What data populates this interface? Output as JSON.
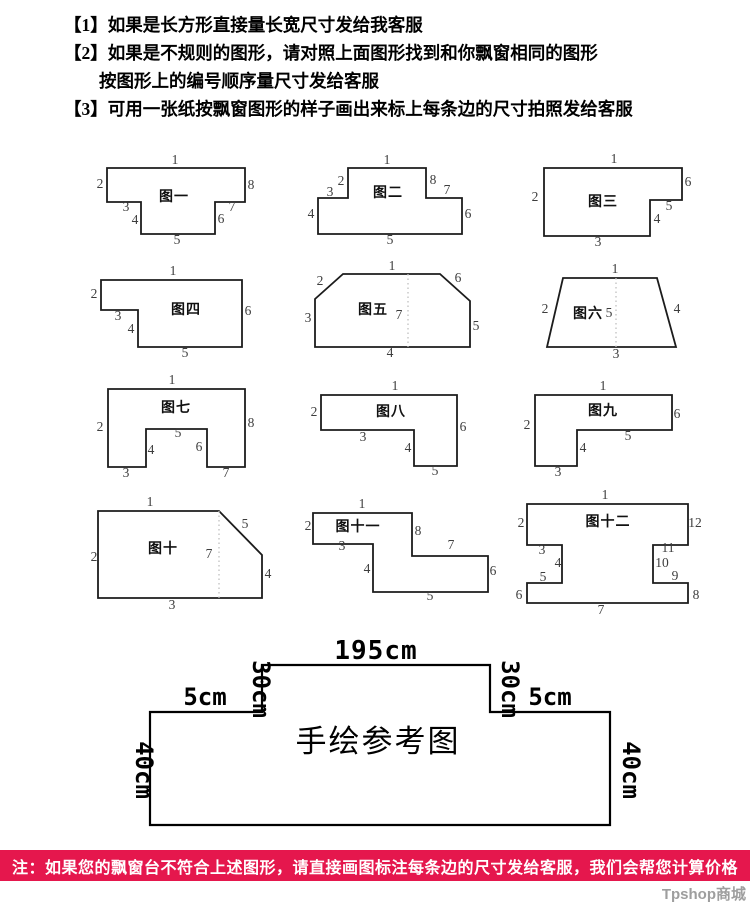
{
  "instructions": [
    "【1】如果是长方形直接量长宽尺寸发给我客服",
    "【2】如果是不规则的图形，请对照上面图形找到和你飘窗相同的图形",
    "按图形上的编号顺序量尺寸发给客服",
    "【3】可用一张纸按飘窗图形的样子画出来标上每条边的尺寸拍照发给客服"
  ],
  "figures": [
    {
      "name": "figure-1",
      "title": "图一",
      "box": [
        95,
        150,
        165,
        95
      ],
      "points": "12,18 150,18 150,52 120,52 120,84 46,84 46,52 12,52",
      "title_pos": [
        79,
        51
      ],
      "labels": [
        [
          "1",
          80,
          14
        ],
        [
          "2",
          5,
          38
        ],
        [
          "3",
          31,
          61
        ],
        [
          "4",
          40,
          74
        ],
        [
          "5",
          82,
          94
        ],
        [
          "6",
          126,
          73
        ],
        [
          "7",
          137,
          61
        ],
        [
          "8",
          156,
          39
        ]
      ]
    },
    {
      "name": "figure-2",
      "title": "图二",
      "box": [
        308,
        150,
        172,
        95
      ],
      "points": "40,18 118,18 118,48 154,48 154,84 10,84 10,48 40,48",
      "title_pos": [
        80,
        47
      ],
      "labels": [
        [
          "1",
          79,
          14
        ],
        [
          "2",
          33,
          35
        ],
        [
          "3",
          22,
          46
        ],
        [
          "4",
          3,
          68
        ],
        [
          "5",
          82,
          94
        ],
        [
          "6",
          160,
          68
        ],
        [
          "7",
          139,
          44
        ],
        [
          "8",
          125,
          34
        ]
      ]
    },
    {
      "name": "figure-3",
      "title": "图三",
      "box": [
        530,
        150,
        165,
        95
      ],
      "points": "14,18 152,18 152,50 120,50 120,86 14,86",
      "title_pos": [
        73,
        56
      ],
      "labels": [
        [
          "1",
          84,
          13
        ],
        [
          "2",
          5,
          51
        ],
        [
          "3",
          68,
          96
        ],
        [
          "4",
          127,
          73
        ],
        [
          "5",
          139,
          60
        ],
        [
          "6",
          158,
          36
        ]
      ]
    },
    {
      "name": "figure-4",
      "title": "图四",
      "box": [
        88,
        262,
        170,
        100
      ],
      "points": "13,18 154,18 154,85 50,85 50,48 13,48",
      "title_pos": [
        98,
        52
      ],
      "labels": [
        [
          "1",
          85,
          13
        ],
        [
          "2",
          6,
          36
        ],
        [
          "3",
          30,
          58
        ],
        [
          "4",
          43,
          71
        ],
        [
          "5",
          97,
          95
        ],
        [
          "6",
          160,
          53
        ]
      ]
    },
    {
      "name": "figure-5",
      "title": "图五",
      "box": [
        300,
        262,
        185,
        100
      ],
      "points": "15,37 43,12 140,12 170,39 170,85 15,85",
      "dotted": [
        108,
        12,
        108,
        85
      ],
      "title_pos": [
        73,
        52
      ],
      "labels": [
        [
          "1",
          92,
          8
        ],
        [
          "2",
          20,
          23
        ],
        [
          "3",
          8,
          60
        ],
        [
          "4",
          90,
          95
        ],
        [
          "5",
          176,
          68
        ],
        [
          "6",
          158,
          20
        ],
        [
          "7",
          99,
          57
        ]
      ]
    },
    {
      "name": "figure-6",
      "title": "图六",
      "box": [
        525,
        262,
        165,
        100
      ],
      "points": "38,16 132,16 151,85 22,85",
      "dotted": [
        91,
        16,
        91,
        85
      ],
      "title_pos": [
        63,
        56
      ],
      "labels": [
        [
          "1",
          90,
          11
        ],
        [
          "2",
          20,
          51
        ],
        [
          "3",
          91,
          96
        ],
        [
          "4",
          152,
          51
        ],
        [
          "5",
          84,
          55
        ]
      ]
    },
    {
      "name": "figure-7",
      "title": "图七",
      "box": [
        95,
        375,
        165,
        105
      ],
      "points": "13,14 150,14 150,92 112,92 112,54 51,54 51,92 13,92",
      "title_pos": [
        81,
        37
      ],
      "labels": [
        [
          "1",
          77,
          9
        ],
        [
          "2",
          5,
          56
        ],
        [
          "3",
          31,
          102
        ],
        [
          "4",
          56,
          79
        ],
        [
          "5",
          83,
          62
        ],
        [
          "6",
          104,
          76
        ],
        [
          "7",
          131,
          102
        ],
        [
          "8",
          156,
          52
        ]
      ]
    },
    {
      "name": "figure-8",
      "title": "图八",
      "box": [
        305,
        375,
        180,
        105
      ],
      "points": "16,20 152,20 152,91 109,91 109,55 16,55",
      "title_pos": [
        86,
        41
      ],
      "labels": [
        [
          "1",
          90,
          15
        ],
        [
          "2",
          9,
          41
        ],
        [
          "3",
          58,
          66
        ],
        [
          "4",
          103,
          77
        ],
        [
          "5",
          130,
          100
        ],
        [
          "6",
          158,
          56
        ]
      ]
    },
    {
      "name": "figure-9",
      "title": "图九",
      "box": [
        518,
        375,
        170,
        105
      ],
      "points": "17,20 154,20 154,55 59,55 59,91 17,91",
      "title_pos": [
        85,
        40
      ],
      "labels": [
        [
          "1",
          85,
          15
        ],
        [
          "2",
          9,
          54
        ],
        [
          "3",
          40,
          101
        ],
        [
          "4",
          65,
          77
        ],
        [
          "5",
          110,
          65
        ],
        [
          "6",
          159,
          43
        ]
      ]
    },
    {
      "name": "figure-10",
      "title": "图十",
      "box": [
        90,
        495,
        200,
        125
      ],
      "points": "8,16 129,16 172,60 172,103 8,103",
      "dotted": [
        129,
        16,
        129,
        103
      ],
      "title_pos": [
        73,
        58
      ],
      "labels": [
        [
          "1",
          60,
          11
        ],
        [
          "2",
          4,
          66
        ],
        [
          "3",
          82,
          114
        ],
        [
          "4",
          178,
          83
        ],
        [
          "5",
          155,
          33
        ],
        [
          "7",
          119,
          63
        ]
      ]
    },
    {
      "name": "figure-11",
      "title": "图十一",
      "box": [
        300,
        495,
        205,
        120
      ],
      "points": "13,18 112,18 112,61 188,61 188,97 73,97 73,49 13,49",
      "title_pos": [
        58,
        36
      ],
      "labels": [
        [
          "1",
          62,
          13
        ],
        [
          "2",
          8,
          35
        ],
        [
          "3",
          42,
          55
        ],
        [
          "4",
          67,
          78
        ],
        [
          "5",
          130,
          105
        ],
        [
          "6",
          193,
          80
        ],
        [
          "7",
          151,
          54
        ],
        [
          "8",
          118,
          40
        ]
      ]
    },
    {
      "name": "figure-12",
      "title": "图十二",
      "box": [
        510,
        487,
        200,
        140
      ],
      "points": "17,17 178,17 178,58 143,58 143,96 178,96 178,116 17,116 17,96 52,96 52,58 17,58",
      "title_pos": [
        98,
        39
      ],
      "labels": [
        [
          "1",
          95,
          12
        ],
        [
          "2",
          11,
          40
        ],
        [
          "3",
          32,
          67
        ],
        [
          "4",
          48,
          80
        ],
        [
          "5",
          33,
          94
        ],
        [
          "6",
          9,
          112
        ],
        [
          "7",
          91,
          127
        ],
        [
          "8",
          186,
          112
        ],
        [
          "9",
          165,
          93
        ],
        [
          "10",
          152,
          80
        ],
        [
          "11",
          158,
          65
        ],
        [
          "12",
          185,
          40
        ]
      ]
    }
  ],
  "hand_drawn": {
    "title": "手绘参考图",
    "top": "195cm",
    "drop_left": "30cm",
    "drop_right": "30cm",
    "ledge_left": "5cm",
    "ledge_right": "5cm",
    "side_left": "40cm",
    "side_right": "40cm"
  },
  "footer": {
    "note": "注：如果您的飘窗台不符合上述图形，请直接画图标注每条边的尺寸发给客服，我们会帮您计算价格",
    "banner_color": "#e5174d",
    "watermark": "Tpshop商城"
  },
  "colors": {
    "line": "#1c1c1c",
    "dotted_line": "#c0c0c0",
    "label_text": "#3d3d3d"
  }
}
